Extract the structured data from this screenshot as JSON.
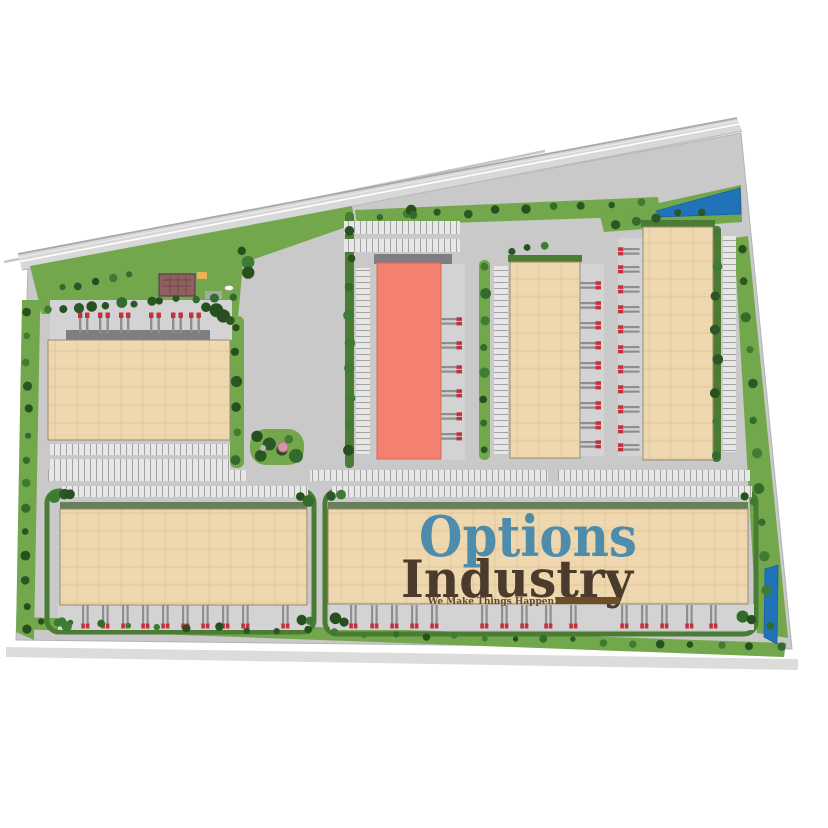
{
  "logo": {
    "line1": "Options",
    "line2": "Industry",
    "tagline": "We Make Things Happen!"
  },
  "colors": {
    "pavement": "#c9c9c9",
    "apron": "#d3d3d3",
    "lawn": "#73a74c",
    "hedge": "#4a7c33",
    "tan": "#eed7ad",
    "red": "#f4806f",
    "water": "#2173b9",
    "truck": "#c4303d",
    "trailer": "#8e8e8e",
    "stall": "#e7e7e7",
    "logo_blue": "#4e8cab",
    "logo_brown": "#4b3b2c",
    "tagline_brown": "#5f4a35",
    "underline_brown": "#6d4e27"
  }
}
